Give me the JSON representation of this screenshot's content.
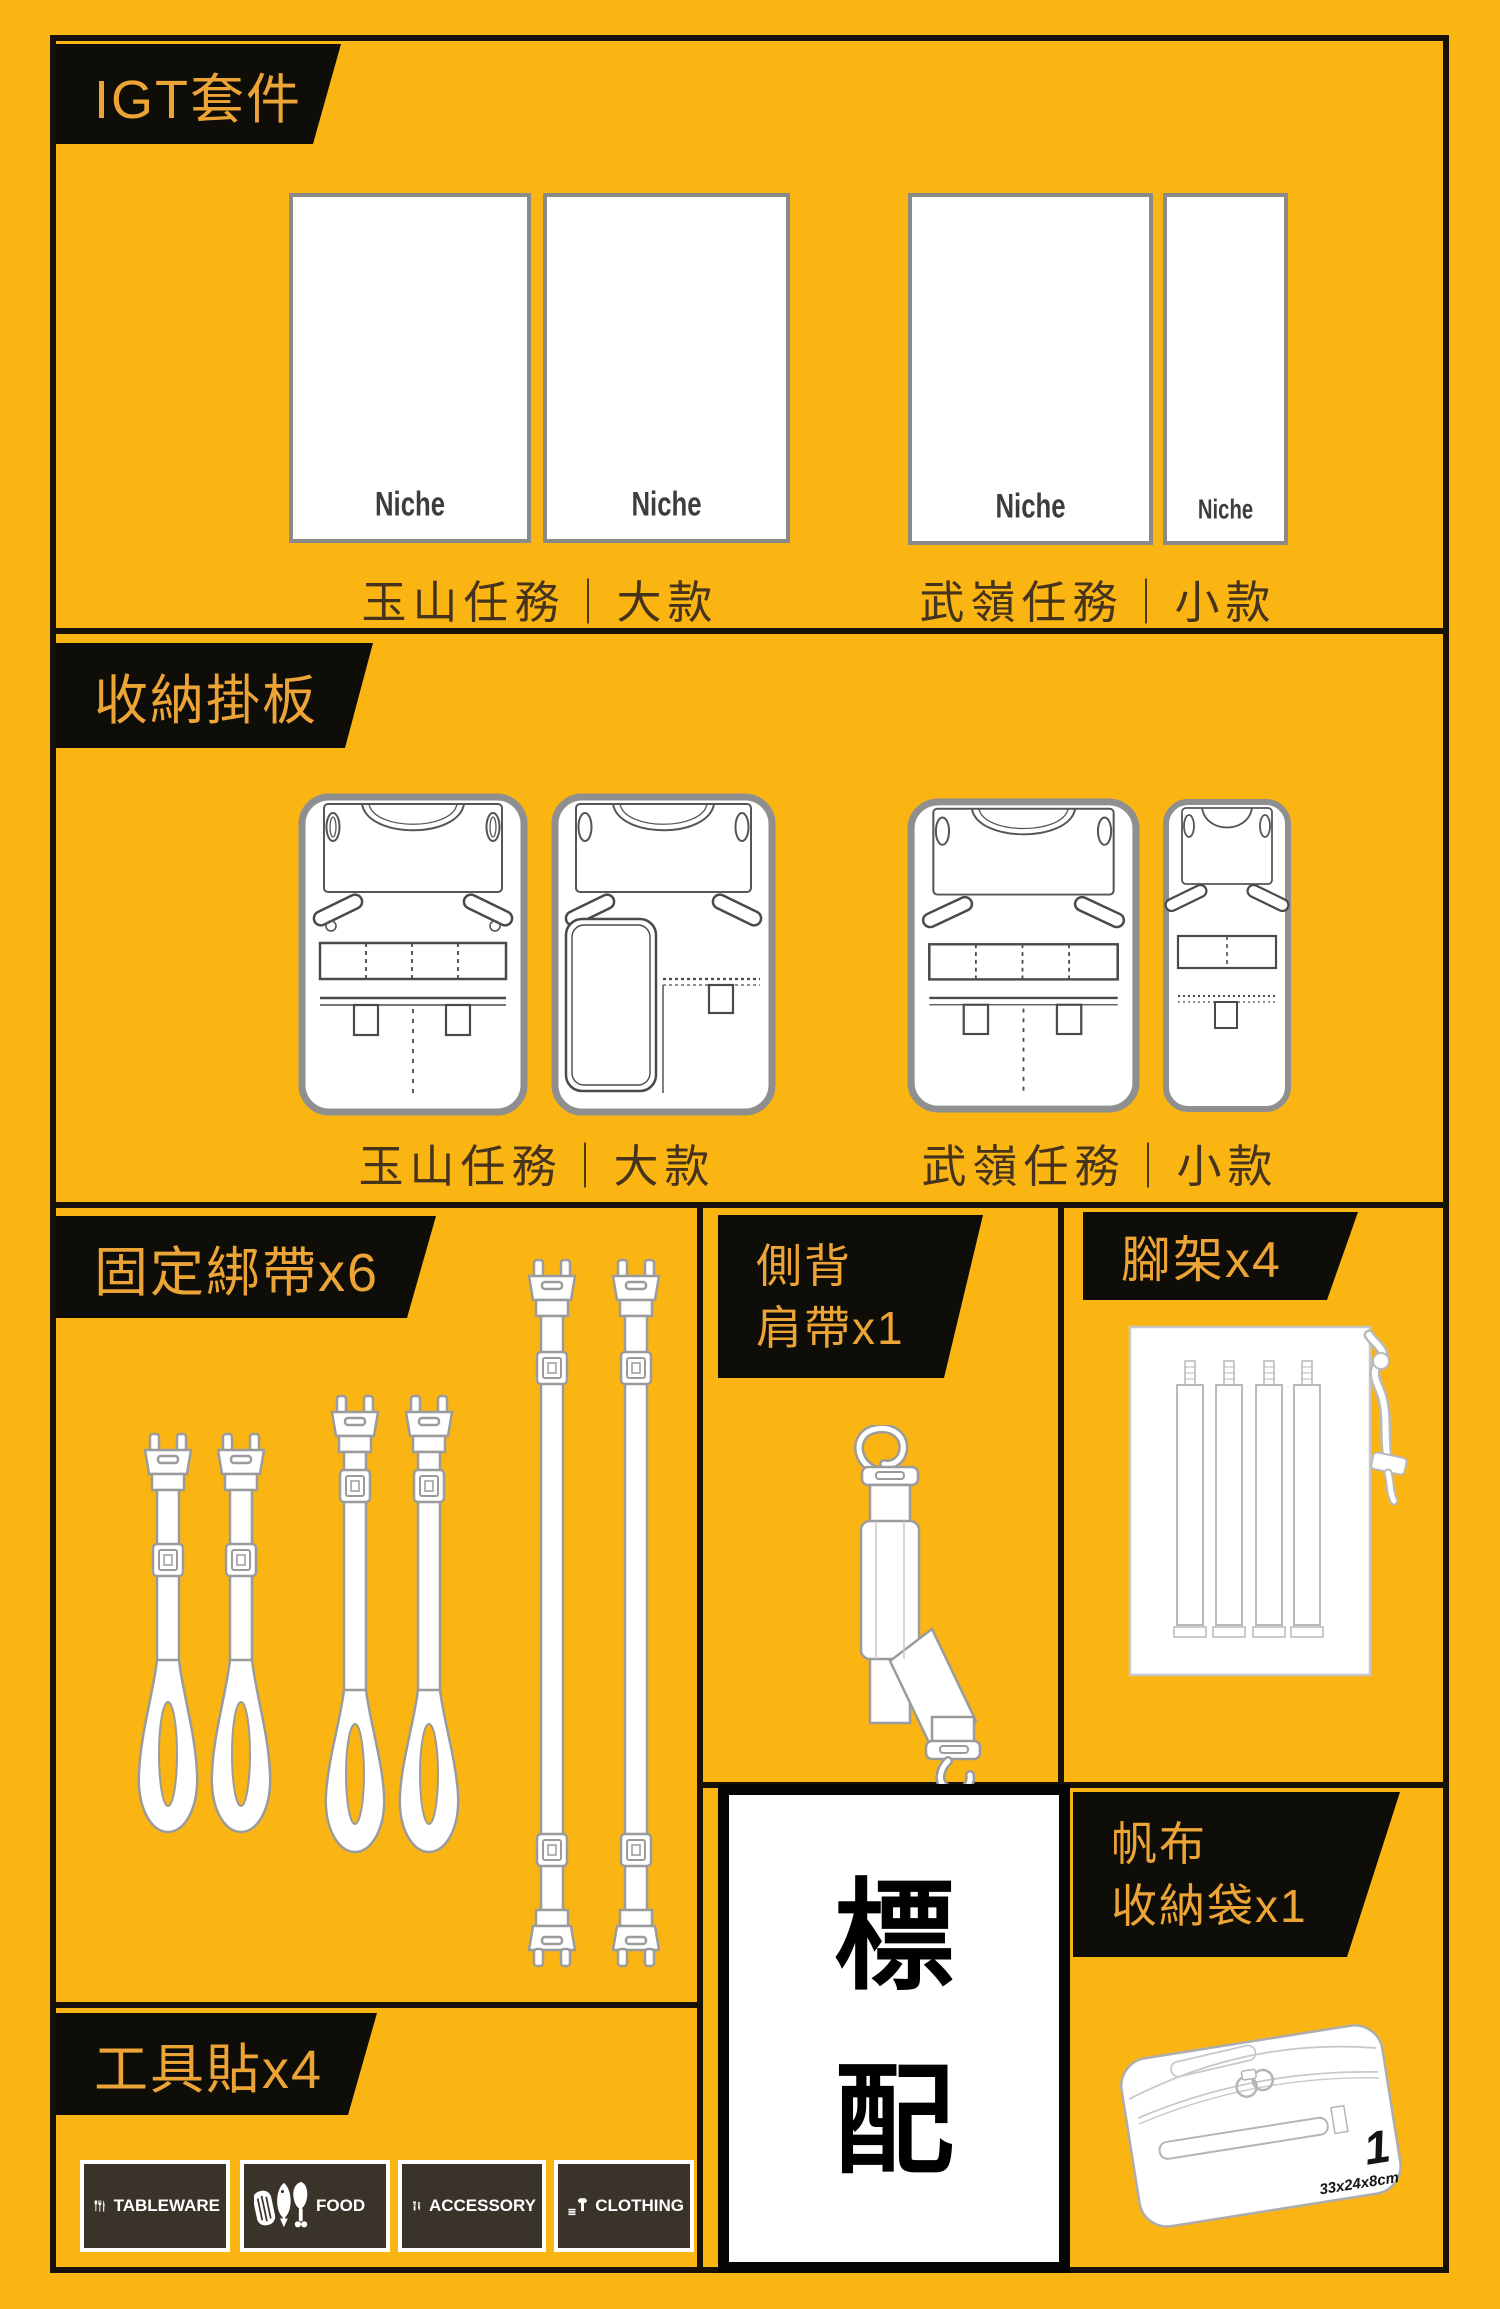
{
  "colors": {
    "background": "#FBB513",
    "banner_bg": "#0F0D07",
    "banner_text": "#EDA437",
    "frame": "#181108",
    "caption_text": "#45331C",
    "panel_border": "#8A8A8A",
    "patch_bg": "#3A332A",
    "white": "#FFFFFF"
  },
  "sections": {
    "igt": {
      "banner": "IGT套件",
      "logo": "Niche",
      "caption_large": "玉山任務｜大款",
      "caption_small": "武嶺任務｜小款"
    },
    "hangboard": {
      "banner": "收納掛板",
      "caption_large": "玉山任務｜大款",
      "caption_small": "武嶺任務｜小款"
    },
    "straps": {
      "banner": "固定綁帶x6"
    },
    "shoulder": {
      "banner_line1": "側背",
      "banner_line2": "肩帶x1"
    },
    "legs": {
      "banner": "腳架x4"
    },
    "standard": {
      "line1": "標",
      "line2": "配"
    },
    "bag": {
      "banner_line1": "帆布",
      "banner_line2": "收納袋x1",
      "number": "1",
      "size": "33x24x8cm"
    },
    "tools": {
      "banner": "工具貼x4",
      "patches": [
        {
          "label": "TABLEWARE"
        },
        {
          "label": "FOOD"
        },
        {
          "label": "ACCESSORY"
        },
        {
          "label": "CLOTHING"
        }
      ]
    }
  }
}
